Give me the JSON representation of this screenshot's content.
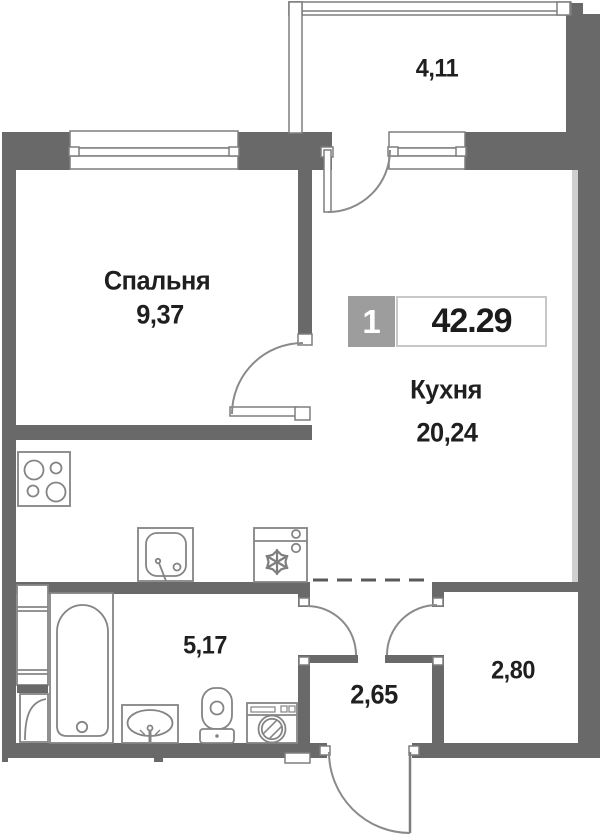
{
  "badge": {
    "number": "1",
    "total_area": "42.29"
  },
  "rooms": {
    "bedroom": {
      "label": "Спальня",
      "area": "9,37"
    },
    "kitchen": {
      "label": "Кухня",
      "area": "20,24"
    },
    "balcony": {
      "area": "4,11"
    },
    "bathroom": {
      "area": "5,17"
    },
    "hallway": {
      "area": "2,65"
    },
    "wardrobe": {
      "area": "2,80"
    }
  },
  "fixtures": {
    "stove": "stove-4-burners",
    "kitchen_sink": "kitchen-sink",
    "fridge": "fridge-snowflake",
    "bathtub": "bathtub",
    "washbasin": "washbasin",
    "toilet": "toilet",
    "washing_machine": "washing-machine",
    "vent_shaft": "vent-shaft"
  },
  "colors": {
    "wall": "#696969",
    "fixture_stroke": "#848484",
    "text": "#1f1f1f",
    "badge_gray": "#9d9d9d",
    "background": "#ffffff"
  }
}
